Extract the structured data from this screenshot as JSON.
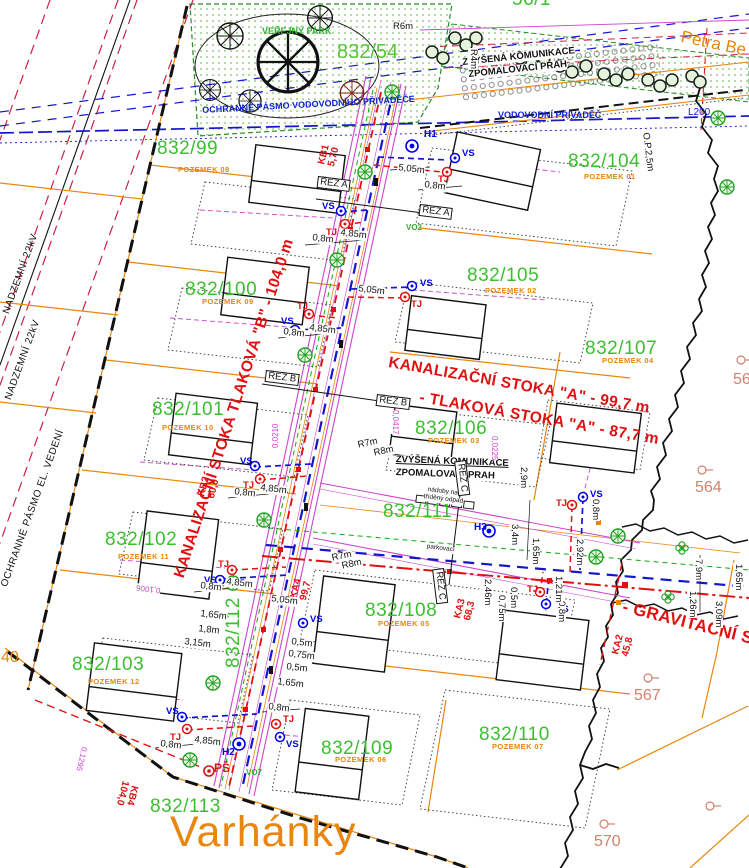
{
  "plan": {
    "locality": "Varhánky",
    "street": "Petra Be",
    "park_name": "VEŘEJNÝ PARK"
  },
  "parcels": [
    {
      "number": "832/54",
      "pozemek": ""
    },
    {
      "number": "832/99",
      "pozemek": "POZEMEK 08"
    },
    {
      "number": "832/100",
      "pozemek": "POZEMEK 09"
    },
    {
      "number": "832/101",
      "pozemek": "POZEMEK 10"
    },
    {
      "number": "832/102",
      "pozemek": "POZEMEK 11"
    },
    {
      "number": "832/103",
      "pozemek": "POZEMEK 12"
    },
    {
      "number": "832/104",
      "pozemek": "POZEMEK 01"
    },
    {
      "number": "832/105",
      "pozemek": "POZEMEK 02"
    },
    {
      "number": "832/106",
      "pozemek": "POZEMEK 03"
    },
    {
      "number": "832/107",
      "pozemek": "POZEMEK 04"
    },
    {
      "number": "832/108",
      "pozemek": "POZEMEK 05"
    },
    {
      "number": "832/109",
      "pozemek": "POZEMEK 06"
    },
    {
      "number": "832/110",
      "pozemek": "POZEMEK 07"
    },
    {
      "number": "832/111",
      "pozemek": ""
    },
    {
      "number": "832/112",
      "pozemek": ""
    },
    {
      "number": "832/113",
      "pozemek": ""
    },
    {
      "number": "56/1",
      "pozemek": ""
    }
  ],
  "neighbors": [
    {
      "number": "40"
    },
    {
      "number": "56"
    },
    {
      "number": "564"
    },
    {
      "number": "567"
    },
    {
      "number": "570"
    }
  ],
  "pipelines": {
    "stoka_a": "KANALIZAČNÍ STOKA \"A\" - 99,7 m",
    "tlakova_a": "- TLAKOVÁ STOKA \"A\" - 87,7 m",
    "stoka_b": "KANALIZAČNÍ STOKA TLAKOVÁ \"B\" - 104,0 m",
    "gravitacni": "- GRAVITAČNÍ STO",
    "ps": "PŠ",
    "shafts": [
      {
        "id": "KA4",
        "len": "99,7"
      },
      {
        "id": "KA3",
        "len": "68,3"
      },
      {
        "id": "KA2",
        "len": "45,8"
      },
      {
        "id": "KB1",
        "len": "5,70"
      },
      {
        "id": "KB2",
        "len": "60,0"
      },
      {
        "id": "KB4",
        "len": "104,0"
      }
    ]
  },
  "zones": {
    "el1": "NADZEMNÍ 22kV",
    "el2": "NADZEMNÍ 22kV",
    "el_pasmo": "OCHRANNÉ PÁSMO EL. VEDENÍ",
    "voda_pasmo": "OCHRANNÉ PÁSMO VODOVODNÍHO PŘIVADĚČE",
    "voda": "VODOVODNÍ PŘIVADĚČ",
    "l200": "L200"
  },
  "road_notes": {
    "zvysena1": "ZVÝŠENÁ KOMUNIKACE",
    "zvysena2": "ZPOMALOVACÍ PRAH",
    "nadoby1": "nádoby na",
    "nadoby2": "tříděný odpad",
    "parking": "parkovací"
  },
  "sections": {
    "a": "ŘEZ A",
    "b": "ŘEZ B",
    "c": "ŘEZ C"
  },
  "markers": {
    "vs": "VS",
    "tj": "TJ",
    "h1": "H1",
    "h2": "H2",
    "h3": "H3",
    "vo2": "VO2",
    "vo7": "VO7"
  },
  "dims": {
    "d08": "0,8m",
    "d485": "4,85m",
    "d505": "5,05m",
    "d165": "1,65m",
    "d18": "1,8m",
    "d315": "3,15m",
    "d05": "0,5m",
    "d075": "0,75m",
    "d29": "2,9m",
    "d34": "3,4m",
    "d246": "2,46m",
    "d292": "2,92m",
    "d121": "1,21m",
    "d79": "7,9m",
    "d126": "1,26m",
    "d309": "3,09m",
    "r4": "R4m",
    "r6": "R6m",
    "r7": "R7m",
    "r8": "R8m",
    "op": "O.P.2,5m"
  },
  "slopes": [
    "0,0417",
    "0,0225",
    "0,0210",
    "0,1295",
    "0,1006"
  ],
  "colors": {
    "parcel_line": "#e8860d",
    "parcel_number": "#3bbf2f",
    "sewer_red": "#e01010",
    "water_blue": "#1515cc",
    "road_magenta": "#cc44cc",
    "boundary_black": "#111111",
    "neighbor": "#d4806c",
    "green_line": "#11aa11",
    "park_dot": "#7cbf6a"
  }
}
